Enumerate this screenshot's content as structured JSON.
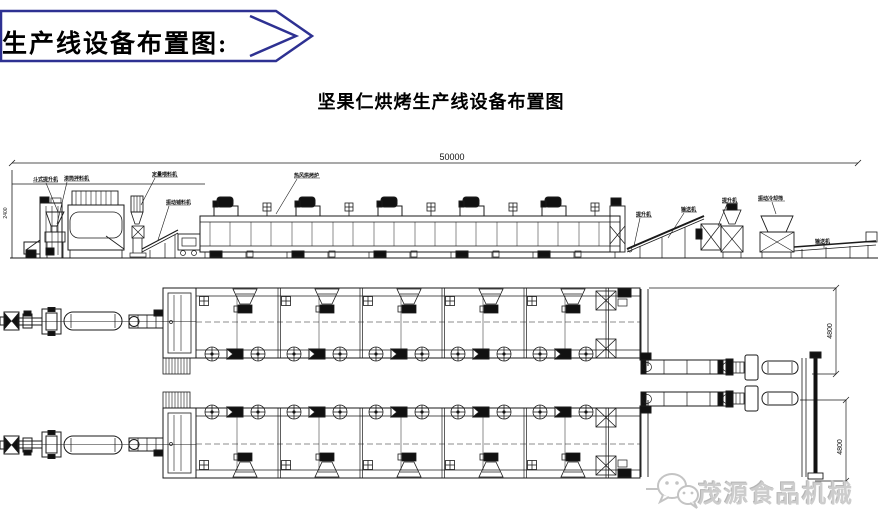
{
  "banner": {
    "label": "生产线设备布置图:"
  },
  "title": "坚果仁烘烤生产线设备布置图",
  "drawing": {
    "dimensions": {
      "total_length": "50000",
      "line1_width": "4800",
      "line2_width": "4800",
      "height_left": "2400"
    },
    "labels": {
      "l1": "斗式提升机",
      "l2": "滚筒拌料机",
      "l3": "定量喂料机",
      "l4": "振动铺料机",
      "l5": "热风烘烤炉",
      "l6": "提升机",
      "l7": "输送机",
      "l8": "提升机",
      "l9": "振动冷却筛",
      "l10": "输送机"
    }
  },
  "watermark": {
    "brand": "茂源食品机械",
    "icon": "wechat-icon"
  }
}
